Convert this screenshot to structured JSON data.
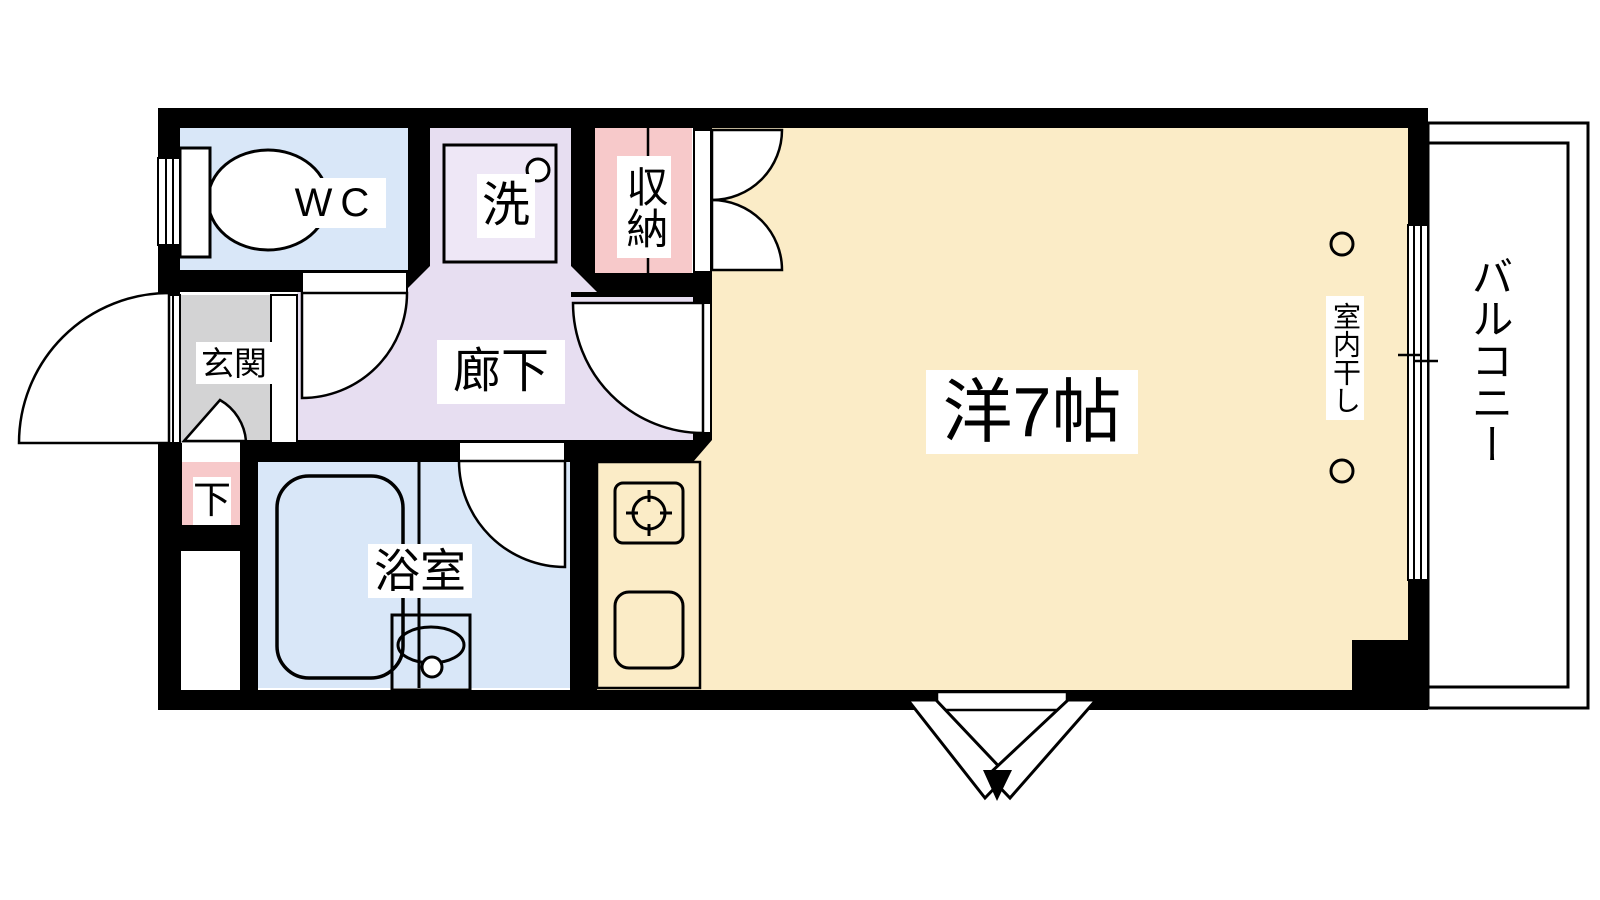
{
  "labels": {
    "wc": "WC",
    "laundry": "洗",
    "storage": "収納",
    "entrance": "玄関",
    "hallway": "廊下",
    "shoe_cabinet": "下",
    "bathroom": "浴室",
    "main_room": "洋7帖",
    "indoor_drying": "室内干し",
    "balcony": "バルコニー"
  },
  "colors": {
    "wall": "#000000",
    "water_blue": "#d9e7f8",
    "corridor_lavender": "#e7def1",
    "washer_fill": "#eee7f6",
    "accent_pink": "#f7c9ca",
    "entrance_gray": "#d3d3d4",
    "room_cream": "#fbecc7",
    "white": "#ffffff",
    "line": "#000000"
  }
}
